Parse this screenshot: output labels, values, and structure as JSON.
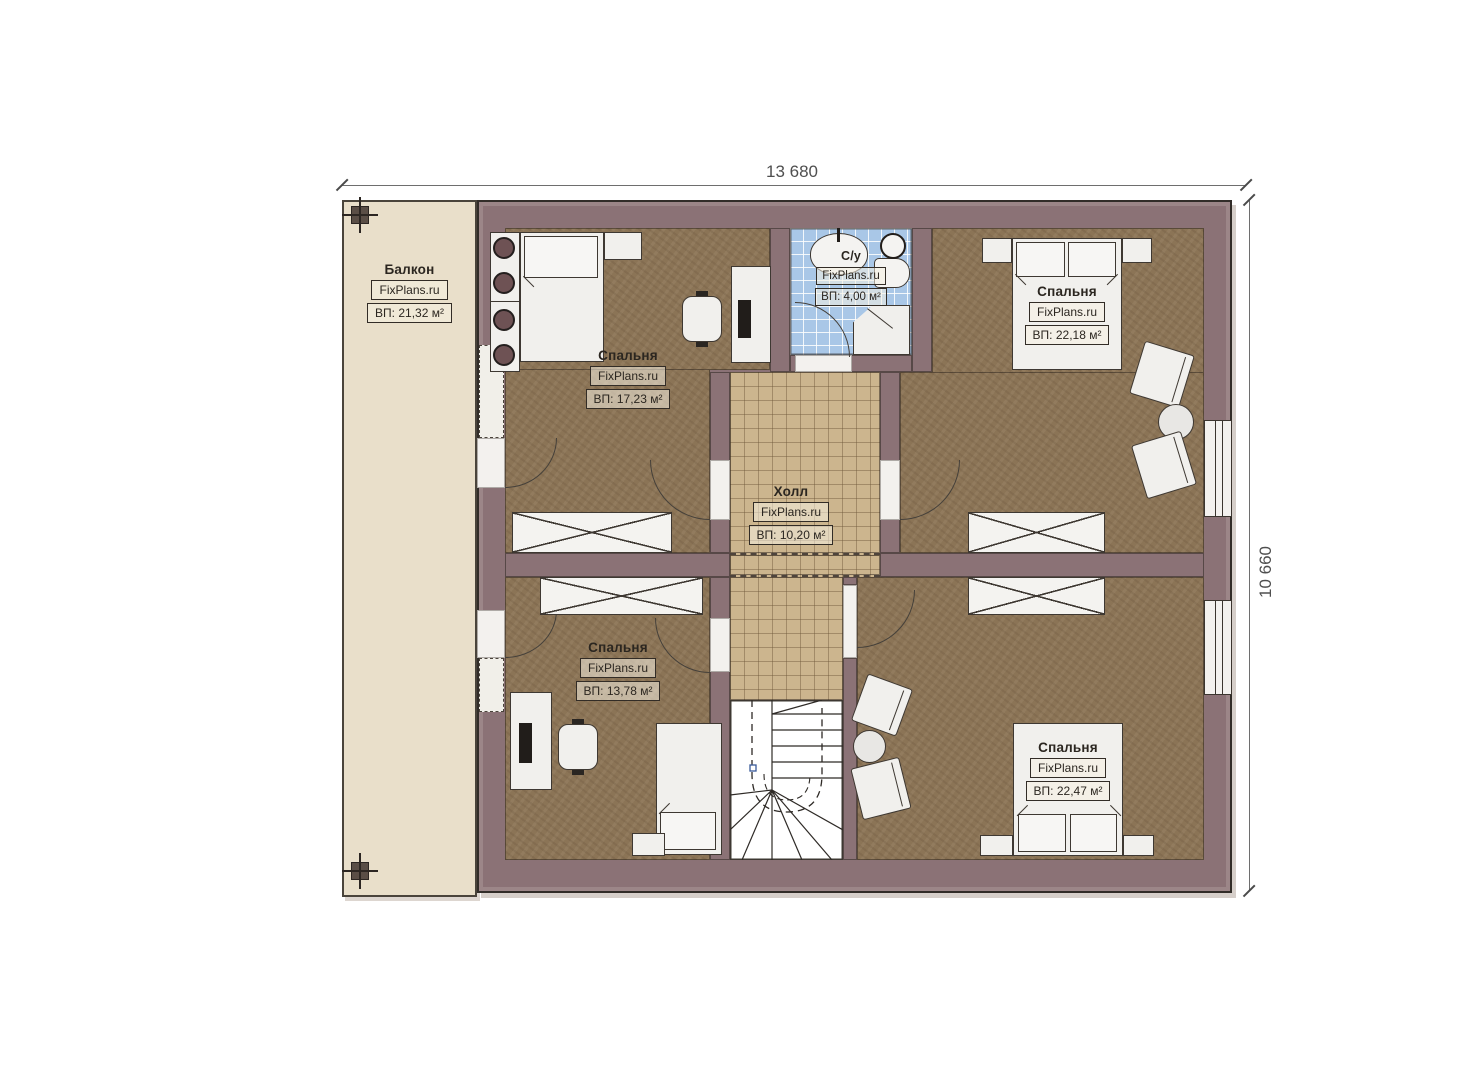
{
  "plan": {
    "dimensions": {
      "width": "13 680",
      "height": "10 660"
    },
    "rooms": {
      "balcony": {
        "name": "Балкон",
        "brand": "FixPlans.ru",
        "area": "ВП: 21,32 м²"
      },
      "bedroom_top_left": {
        "name": "Спальня",
        "brand": "FixPlans.ru",
        "area": "ВП: 17,23 м²"
      },
      "bathroom": {
        "name": "С/у",
        "brand": "FixPlans.ru",
        "area": "ВП: 4,00 м²"
      },
      "bedroom_top_right": {
        "name": "Спальня",
        "brand": "FixPlans.ru",
        "area": "ВП: 22,18 м²"
      },
      "hall": {
        "name": "Холл",
        "brand": "FixPlans.ru",
        "area": "ВП: 10,20 м²"
      },
      "bedroom_bottom_left": {
        "name": "Спальня",
        "brand": "FixPlans.ru",
        "area": "ВП: 13,78 м²"
      },
      "bedroom_bottom_right": {
        "name": "Спальня",
        "brand": "FixPlans.ru",
        "area": "ВП: 22,47 м²"
      }
    },
    "colors": {
      "wall": "#8b7276",
      "bedroom_floor": "#8b7456",
      "hall_floor": "#ccb58e",
      "bathroom_floor": "#a9c7e7",
      "balcony_floor": "#e9dfca",
      "stairs": "#ffffff"
    }
  }
}
